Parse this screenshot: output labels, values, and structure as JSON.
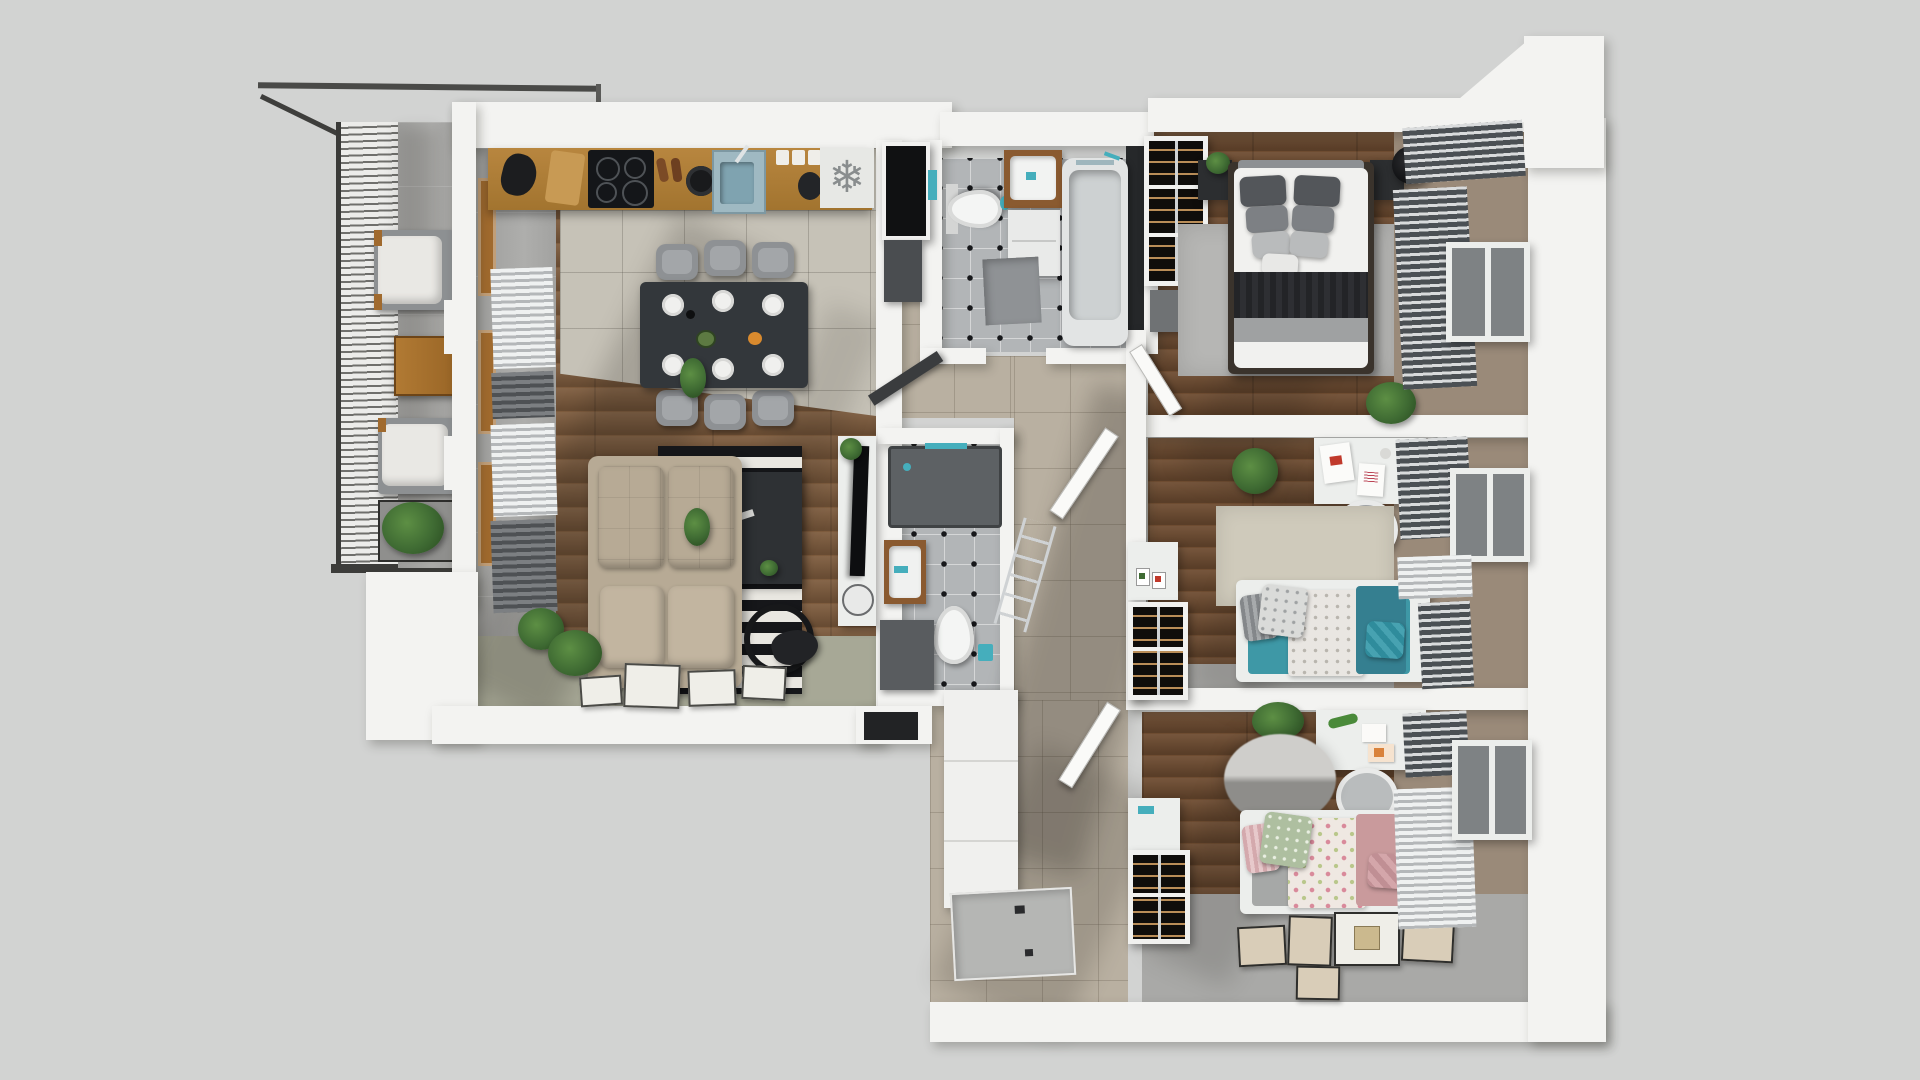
{
  "palette": {
    "background": "#d2d3d2",
    "wall": "#f3f3f1",
    "wood_living": "#7d5b3d",
    "wood_dark": "#6e4c31",
    "tile_kitchen": "#c6c2b7",
    "tile_bath": "#b2b5b7",
    "tile_hall": "#b9b0a1",
    "sage": "#a7a896",
    "carpet_gray": "#a9a9a7",
    "counter": "#ab7c3b",
    "charcoal": "#35383c",
    "black": "#16171a",
    "sofa": "#b7aa95",
    "rug_light": "#e9e7e1",
    "chair_gray": "#8e9194",
    "teal": "#45aebc",
    "pink": "#cfa0a5",
    "white_furn": "#eceeec",
    "glass": "#7e8284",
    "blind_dark": "#4b5054",
    "slat_light": "#eff1f1",
    "metal": "#cfd2d4",
    "plant": "#3f6b33",
    "plant_dark": "#2d5124",
    "snowflake": "#898d8e",
    "wood_frame": "#a06a2e"
  },
  "kitchen": {
    "fridge_icon_glyph": "❄"
  },
  "inventory": {
    "balcony": [
      "glass-louver-screen",
      "lounge-chair",
      "lounge-chair",
      "wood-table",
      "planter-shrub"
    ],
    "living_kitchen": [
      "kitchen-counter",
      "induction-hob",
      "sink",
      "fridge-marker",
      "dining-table",
      "six-dining-chairs",
      "corner-sofa",
      "striped-rug",
      "coffee-table",
      "tv-console",
      "tv",
      "floor-frames",
      "ferns"
    ],
    "bathroom_main": [
      "toilet",
      "vanity-sink",
      "bathtub",
      "bath-mat"
    ],
    "bathroom_shower": [
      "shower-tray",
      "vanity-sink",
      "toilet",
      "storage-bench"
    ],
    "hallway": [
      "wardrobe-closet",
      "entrance-mat",
      "towel-ladder"
    ],
    "bedroom": [
      "double-bed",
      "nightstand",
      "nightstand",
      "table-lamp",
      "wine-rack-shelf",
      "area-rug",
      "plant",
      "window-blinds"
    ],
    "kids_room_teal": [
      "desk",
      "desk-chair",
      "single-bed-teal",
      "area-rug",
      "slatted-shelf",
      "window-blinds"
    ],
    "kids_room_pink": [
      "desk",
      "desk-chair",
      "single-bed-floral",
      "round-fluffy-rug",
      "slatted-shelf",
      "floor-art-frames",
      "window-blinds"
    ]
  }
}
